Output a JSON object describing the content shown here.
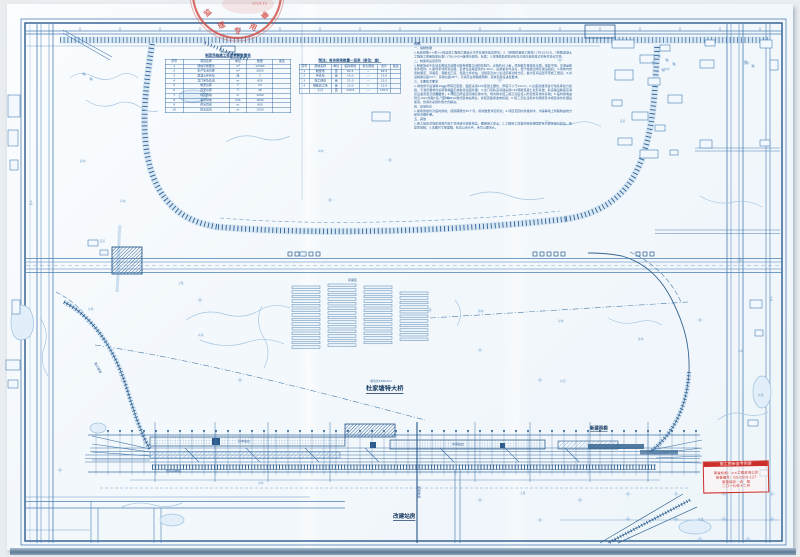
{
  "drawing": {
    "type": "railway-station-and-beam-yard-site-plan",
    "seal": {
      "chars": [
        {
          "text": "监",
          "x": 203,
          "y": 13,
          "rot": -42,
          "s": 0.9,
          "cls": "seal-char"
        },
        {
          "text": "理",
          "x": 217,
          "y": 24,
          "rot": -22,
          "s": 0.9,
          "cls": "seal-char"
        },
        {
          "text": "专",
          "x": 234,
          "y": 28,
          "rot": 0,
          "s": 0.9,
          "cls": "seal-char"
        },
        {
          "text": "用",
          "x": 251,
          "y": 23,
          "rot": 22,
          "s": 0.9,
          "cls": "seal-char"
        },
        {
          "text": "章",
          "x": 264,
          "y": 11,
          "rot": 42,
          "s": 0.9,
          "cls": "seal-char"
        },
        {
          "text": "2019.12",
          "x": 252,
          "y": 2,
          "rot": 0,
          "s": 0.6,
          "cls": "seal-date"
        }
      ]
    },
    "red_stamp": {
      "header": "施工图审查专用章",
      "lines": [
        "审查机构：××工程咨询公司",
        "审查编号：GS-2019-127",
        "审查结论：合　格",
        "二〇一九年十二月"
      ]
    }
  },
  "tables": {
    "left": {
      "title": "制梁场临建工程及材料数量表",
      "headers": [
        "序号",
        "项目名称",
        "单位",
        "数量",
        "备注"
      ],
      "rows": [
        [
          "1",
          "场地平整硬化",
          "m²",
          "12500",
          ""
        ],
        [
          "2",
          "生产生活房屋",
          "m²",
          "2800",
          ""
        ],
        [
          "3",
          "混凝土拌合站",
          "座",
          "2",
          ""
        ],
        [
          "4",
          "龙门吊及轨道",
          "m",
          "850",
          ""
        ],
        [
          "5",
          "制梁台座",
          "个",
          "24",
          ""
        ],
        [
          "6",
          "存梁台座",
          "个",
          "48",
          ""
        ],
        [
          "7",
          "场区围墙",
          "m",
          "1260",
          ""
        ],
        [
          "8",
          "临时供电",
          "kVA",
          "1600",
          ""
        ],
        [
          "9",
          "供水管线",
          "m",
          "900",
          ""
        ],
        [
          "10",
          "排水边沟",
          "m",
          "1500",
          ""
        ]
      ]
    },
    "right": {
      "title": "附注：有关用地数量一览表（单位：亩）",
      "headers": [
        "序号",
        "用地名称",
        "单位",
        "临时用地",
        "永久用地",
        "合计",
        "备注"
      ],
      "rows": [
        [
          "1",
          "制梁场",
          "亩",
          "82.5",
          "—",
          "82.5",
          ""
        ],
        [
          "2",
          "拌合站",
          "亩",
          "15.0",
          "—",
          "15.0",
          ""
        ],
        [
          "3",
          "施工便道",
          "亩",
          "21.0",
          "—",
          "21.0",
          ""
        ],
        [
          "4",
          "钢筋加工场",
          "亩",
          "12.0",
          "—",
          "12.0",
          ""
        ],
        [
          "",
          "小计",
          "亩",
          "130.5",
          "—",
          "130.5",
          ""
        ]
      ]
    }
  },
  "notes": {
    "paragraphs": [
      "说明：",
      "一、编制依据",
      "1.新建铁路××至××段站前工程施工图设计文件及相关批复意见；2.《铁路桥涵施工规范》(TB10203)、《铁路混凝土工程施工质量验收标准》(TB10424)等现行规范、标准；3.现场踏勘调查资料及与地方政府签订的有关协议文件。",
      "二、制梁场设置原则",
      "1.制梁场设于车站北侧地方道路与既有铁路之间的空地内，占地约82.5亩，原地貌为旱地及水塘，地势平坦，交通运输条件便利；2.梁场紧邻既有道路，至桥位运梁距离约1.2km，运架梁条件良好，便于箱梁出场及架设组织；3.场地内布置制梁区、存梁区、钢筋加工区、混凝土拌合站、试验室及办公生活区等功能分区，各分区间设置环形施工便道；4.共设制梁台座24个、存梁台座48个，可满足全桥箱梁预制、存放及架设进度要求。",
      "三、主要技术要求",
      "1.场地整平后铺筑20cm厚碎石垫层，面层采用C25混凝土硬化，厚度不小于20cm；2.台座基础须进行地基承载力检验，不满足要求时采用换填碎石或桩基加固处理；3.龙门吊轨道基础采用C30钢筋混凝土条形基础，轨道铺设精度应满足设备安装及使用要求；4.场区四周设置围墙及排水沟，场内排水经三级沉淀后接入附近既有排水系统；5.临时用电由附近10kV线路T接，设630kVA箱式变电站两台，并配置备用发电机组；6.施工及生活用水利用既有水塘经净化处理后使用，饮用水采用外购方式解决。",
      "四、征地拆迁",
      "1.梁场用地均为临时用地，使用期限约30个月，用地数量详见附表；2.场区范围内零星树木、沟渠等地上附着物由地方配合清理补偿。",
      "五、其他",
      "1.施工前应对场区范围内地下管线进行调查核实，确保施工安全；2.工程完工后临时用地按国家有关规定进行复垦，恢复原地貌；3.本图尺寸除里程、标高以米计外，余均以厘米计。"
    ]
  },
  "labels": {
    "major": [
      {
        "text": "杜家塘特大桥",
        "x": 366,
        "y": 386,
        "s": 0.78,
        "cls": "lbl-major"
      },
      {
        "text": "（桥全长1286.4m）",
        "x": 368,
        "y": 380,
        "s": 0.45,
        "cls": "lbl-sub"
      },
      {
        "text": "改建站房",
        "x": 393,
        "y": 514,
        "s": 0.7,
        "cls": "lbl-major"
      },
      {
        "text": "新建雨棚",
        "x": 590,
        "y": 426,
        "s": 0.55,
        "cls": "lbl-major"
      }
    ],
    "station": [
      {
        "text": "基本站台",
        "x": 238,
        "y": 440,
        "s": 0.5,
        "cls": "lbl-st"
      },
      {
        "text": "中间站台",
        "x": 452,
        "y": 443,
        "s": 0.5,
        "cls": "lbl-st"
      },
      {
        "text": "旅客地道",
        "x": 420,
        "y": 486,
        "rot": 90,
        "s": 0.5,
        "cls": "lbl-st"
      },
      {
        "text": "既有货物线",
        "x": 166,
        "y": 470,
        "s": 0.5,
        "cls": "lbl-st"
      },
      {
        "text": "存梁区",
        "x": 348,
        "y": 279,
        "s": 0.5,
        "cls": "lbl-st"
      },
      {
        "text": "施工便道",
        "x": 96,
        "y": 362,
        "rot": 62,
        "s": 0.5,
        "cls": "lbl-st"
      }
    ],
    "texture": [
      {
        "text": "水塘",
        "x": 88,
        "y": 308,
        "s": 0.45,
        "cls": "lbl-tex"
      },
      {
        "text": "水塘",
        "x": 198,
        "y": 334,
        "s": 0.45,
        "cls": "lbl-tex"
      },
      {
        "text": "水塘",
        "x": 698,
        "y": 518,
        "s": 0.45,
        "cls": "lbl-tex"
      },
      {
        "text": "水塘",
        "x": 758,
        "y": 394,
        "s": 0.45,
        "cls": "lbl-tex"
      },
      {
        "text": "旱地",
        "x": 318,
        "y": 150,
        "s": 0.45,
        "cls": "lbl-tex"
      },
      {
        "text": "旱地",
        "x": 558,
        "y": 320,
        "s": 0.45,
        "cls": "lbl-tex"
      },
      {
        "text": "旱地",
        "x": 120,
        "y": 200,
        "s": 0.45,
        "cls": "lbl-tex"
      },
      {
        "text": "旱地",
        "x": 738,
        "y": 350,
        "s": 0.45,
        "cls": "lbl-tex"
      },
      {
        "text": "旱地",
        "x": 258,
        "y": 482,
        "s": 0.45,
        "cls": "lbl-tex"
      },
      {
        "text": "菜地",
        "x": 80,
        "y": 160,
        "s": 0.45,
        "cls": "lbl-tex"
      },
      {
        "text": "菜地",
        "x": 478,
        "y": 310,
        "s": 0.45,
        "cls": "lbl-tex"
      },
      {
        "text": "菜地",
        "x": 638,
        "y": 338,
        "s": 0.45,
        "cls": "lbl-tex"
      },
      {
        "text": "民房",
        "x": 620,
        "y": 120,
        "s": 0.45,
        "cls": "lbl-tex"
      },
      {
        "text": "民房",
        "x": 100,
        "y": 240,
        "s": 0.45,
        "cls": "lbl-tex"
      },
      {
        "text": "民房",
        "x": 744,
        "y": 62,
        "s": 0.45,
        "cls": "lbl-tex"
      },
      {
        "text": "水渠",
        "x": 32,
        "y": 200,
        "rot": 90,
        "s": 0.45,
        "cls": "lbl-tex"
      },
      {
        "text": "水渠",
        "x": 772,
        "y": 296,
        "rot": 90,
        "s": 0.45,
        "cls": "lbl-tex"
      },
      {
        "text": "土路",
        "x": 178,
        "y": 282,
        "s": 0.45,
        "cls": "lbl-tex"
      },
      {
        "text": "土路",
        "x": 520,
        "y": 492,
        "s": 0.45,
        "cls": "lbl-tex"
      },
      {
        "text": "林地",
        "x": 440,
        "y": 96,
        "s": 0.45,
        "cls": "lbl-tex"
      },
      {
        "text": "林地",
        "x": 664,
        "y": 68,
        "s": 0.45,
        "cls": "lbl-tex"
      },
      {
        "text": "水田",
        "x": 560,
        "y": 380,
        "s": 0.45,
        "cls": "lbl-tex"
      }
    ]
  }
}
